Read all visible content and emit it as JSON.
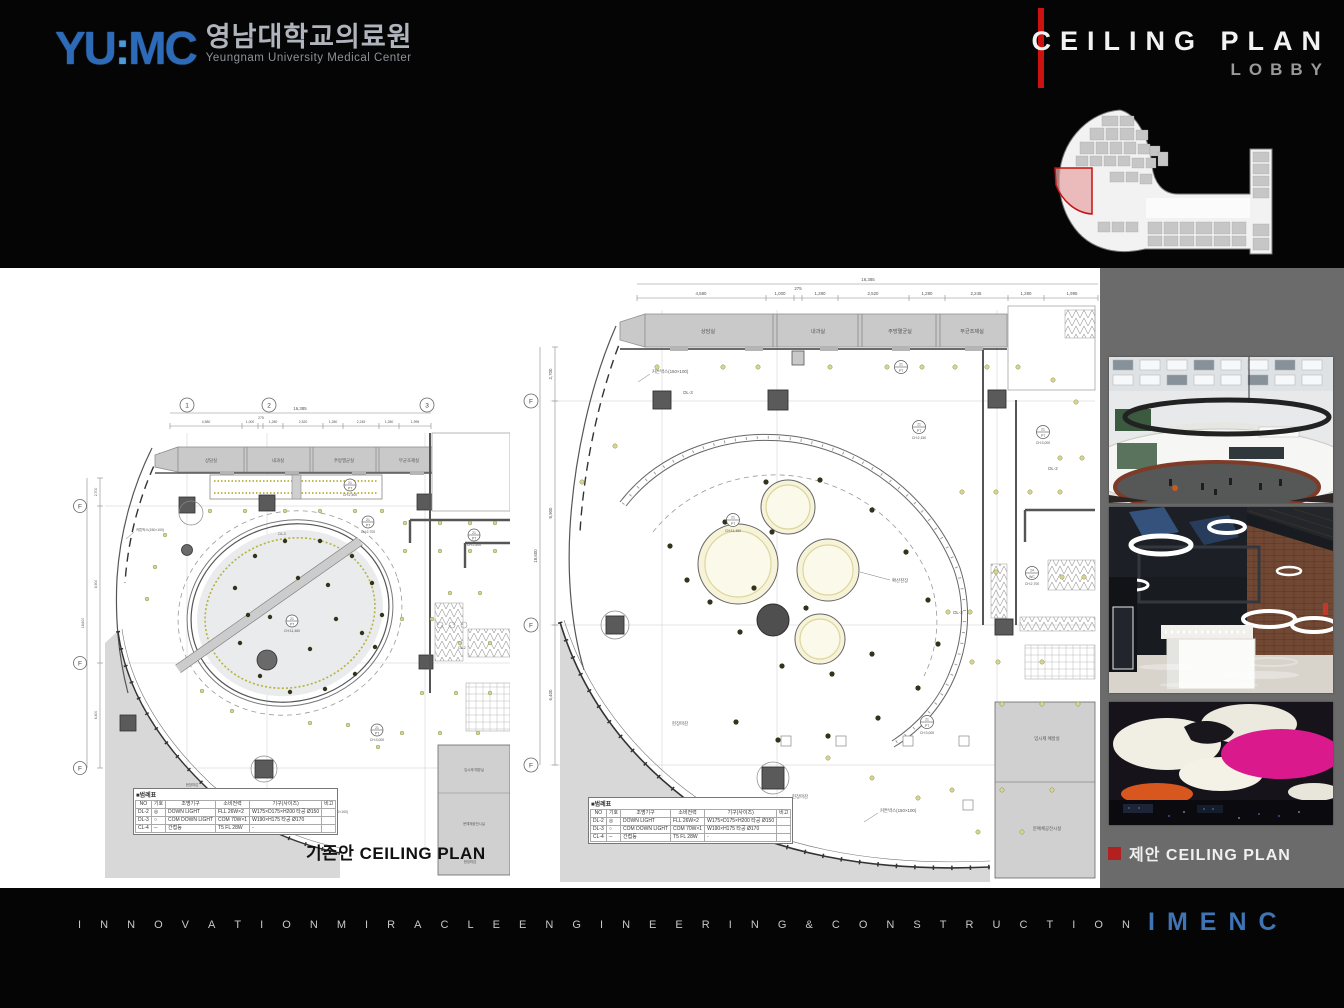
{
  "header": {
    "logo_text_left": "YU",
    "logo_text_colon": ":",
    "logo_text_right": "MC",
    "logo_kr": "영남대학교의료원",
    "logo_en": "Yeungnam University Medical Center",
    "title": "CEILING PLAN",
    "subtitle": "LOBBY"
  },
  "captions": {
    "existing_kr": "기존안",
    "existing_en": "CEILING PLAN",
    "proposed_kr": "제안",
    "proposed_en": "CEILING PLAN"
  },
  "plans": {
    "dim_total_h": "16,385",
    "dims_top": [
      "4,580",
      "1,000",
      "275",
      "1,280",
      "2,520",
      "1,280",
      "2,245",
      "1,280",
      "1,995"
    ],
    "dim_total_v": "18,600",
    "dims_left": [
      "2,700",
      "8,900",
      "6,400"
    ],
    "grid_cols": [
      "1",
      "2",
      "3"
    ],
    "grid_row": "F",
    "rooms": [
      "상담실",
      "내과실",
      "주방멸균실",
      "무균조제실"
    ],
    "side_room_1": "임시제 예방실",
    "side_room_2": "문예체공전시실",
    "floor_label": "현장마감",
    "ann": {
      "curtain_box": "커튼박스(150×100)",
      "diffuse": "확산천장",
      "dl3": "DL-3",
      "dl2": "DL-2",
      "ch_2150": "CH:2,150",
      "ch_2400": "CH:2,400",
      "ch_2700": "CH:2,700",
      "ch_3000": "CH:3,000",
      "ch_11460": "CH:11,460",
      "sym_top": "21",
      "sym_bot": "PT",
      "sym_24": "24",
      "sym_wc": "WC"
    },
    "legend": {
      "title": "■범례표",
      "headers": [
        "NO",
        "기호",
        "조명기구",
        "소비전력",
        "기구(사이즈)",
        "비고"
      ],
      "rows": [
        {
          "no": "DL-2",
          "sym": "◎",
          "name": "DOWN LIGHT",
          "power": "FLL 26W×2",
          "size": "W175×D175×H200 타공 Ø150",
          "note": ""
        },
        {
          "no": "DL-3",
          "sym": "○",
          "name": "COM DOWN LIGHT",
          "power": "COM 70W×1",
          "size": "W190×H175 타공 Ø170",
          "note": ""
        },
        {
          "no": "CL-4",
          "sym": "─",
          "name": "간접등",
          "power": "T5 FL 28W",
          "size": "-",
          "note": ""
        }
      ]
    }
  },
  "footer": {
    "tagline": "INNOVATION MIRACLE ENGINEERING & CONSTRUCTION",
    "brand": "IMENC"
  }
}
